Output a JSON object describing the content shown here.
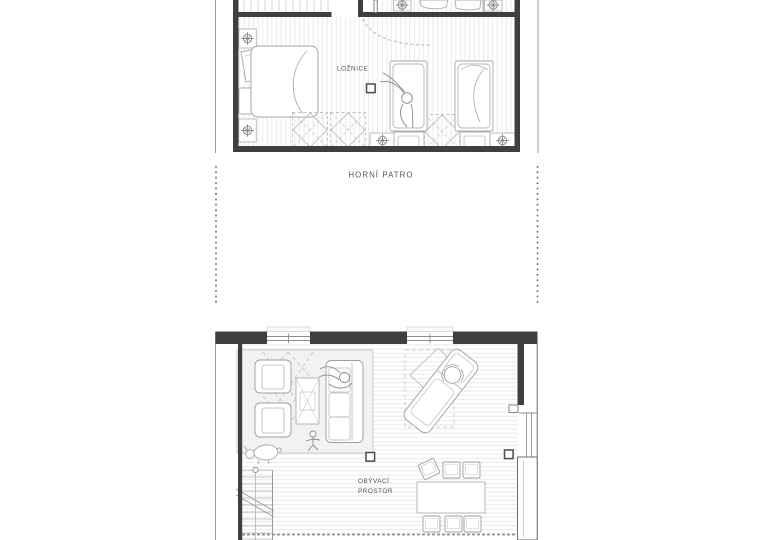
{
  "plans": {
    "upper": {
      "room_label": "LOŽNICE",
      "floor_label": "HORNÍ PATRO"
    },
    "lower": {
      "room_label_line1": "OBÝVACÍ",
      "room_label_line2": "PROSTOR"
    }
  },
  "colors": {
    "wall": "#3f3f3f",
    "furniture_line": "#9e9e9e",
    "floor_stripe": "#e9e9e9",
    "rug_fill": "#f2f2f2",
    "section_dash_line": "#6e6e6e",
    "text": "#525252"
  },
  "icons": {
    "ceiling_light": "crosshair-circle-symbol",
    "wall_switch": "small-square-symbol",
    "door_swing": "dashed-arc-symbol",
    "stair_direction": "circle-start-symbol",
    "section_cut": "vertical-dashed-line"
  }
}
